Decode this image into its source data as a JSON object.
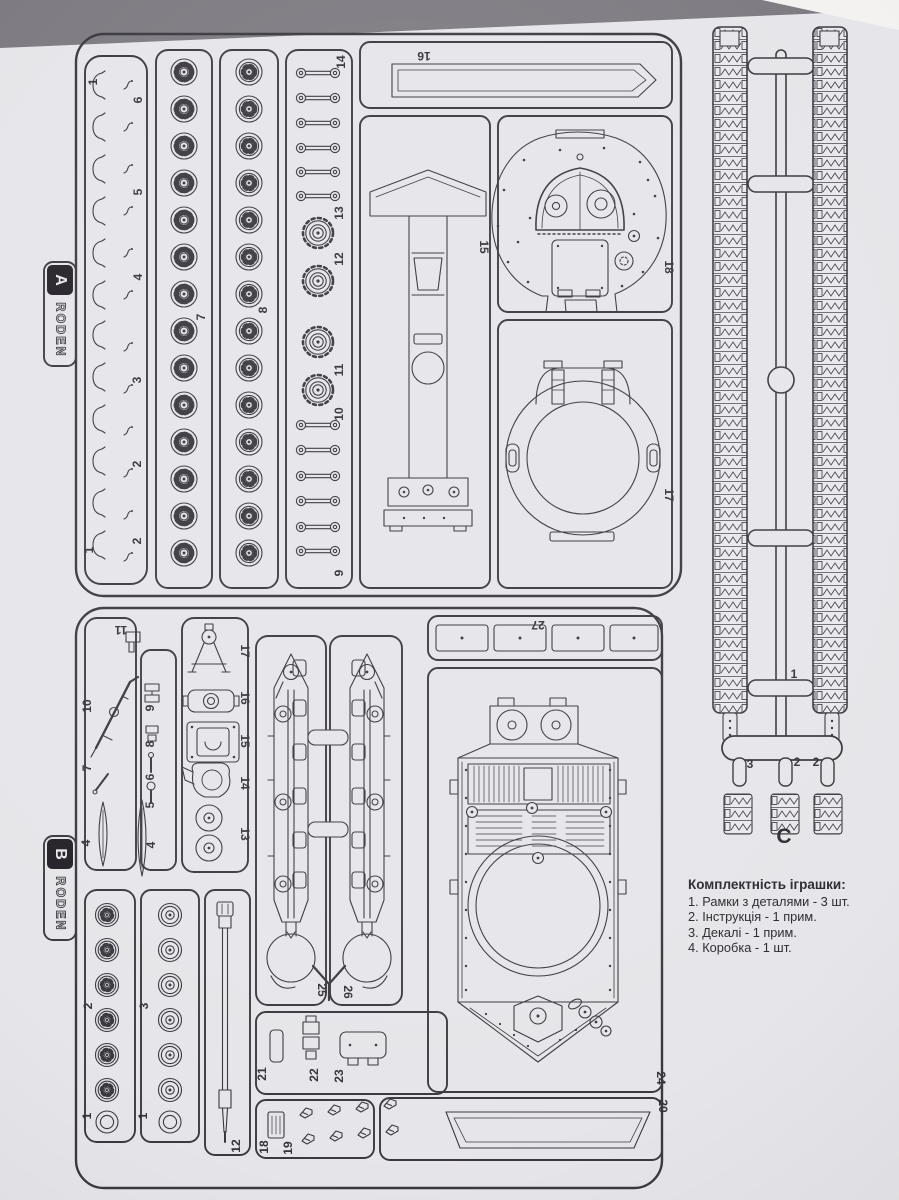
{
  "photo": {
    "table_color": "#7d7a81",
    "corner_sheet_color": "#f3f2f0",
    "paper_color": "#e6e5e9",
    "ink_color": "#3b3940",
    "tab_color": "#232127"
  },
  "brand": {
    "name": "RODEN",
    "sprue_a_letter": "A",
    "sprue_b_letter": "B"
  },
  "sprue_a": {
    "labels": [
      "1",
      "6",
      "5",
      "4",
      "3",
      "2",
      "2",
      "1",
      "7",
      "8",
      "14",
      "13",
      "12",
      "11",
      "10",
      "9",
      "16",
      "15",
      "18",
      "17"
    ]
  },
  "sprue_b": {
    "labels": [
      "11",
      "10",
      "9",
      "8",
      "7",
      "6",
      "5",
      "4",
      "4",
      "17",
      "16",
      "15",
      "14",
      "13",
      "2",
      "1",
      "3",
      "1",
      "12",
      "25",
      "26",
      "27",
      "24",
      "20",
      "21",
      "22",
      "23",
      "18",
      "19"
    ]
  },
  "sprue_c": {
    "letter": "C",
    "labels": [
      "1",
      "3",
      "2",
      "2"
    ]
  },
  "contents": {
    "title": "Комплектність іграшки:",
    "items": [
      "1. Рамки з деталями - 3 шт.",
      "2. Інструкція - 1 прим.",
      "3. Декалі - 1 прим.",
      "4. Коробка - 1 шт."
    ]
  }
}
